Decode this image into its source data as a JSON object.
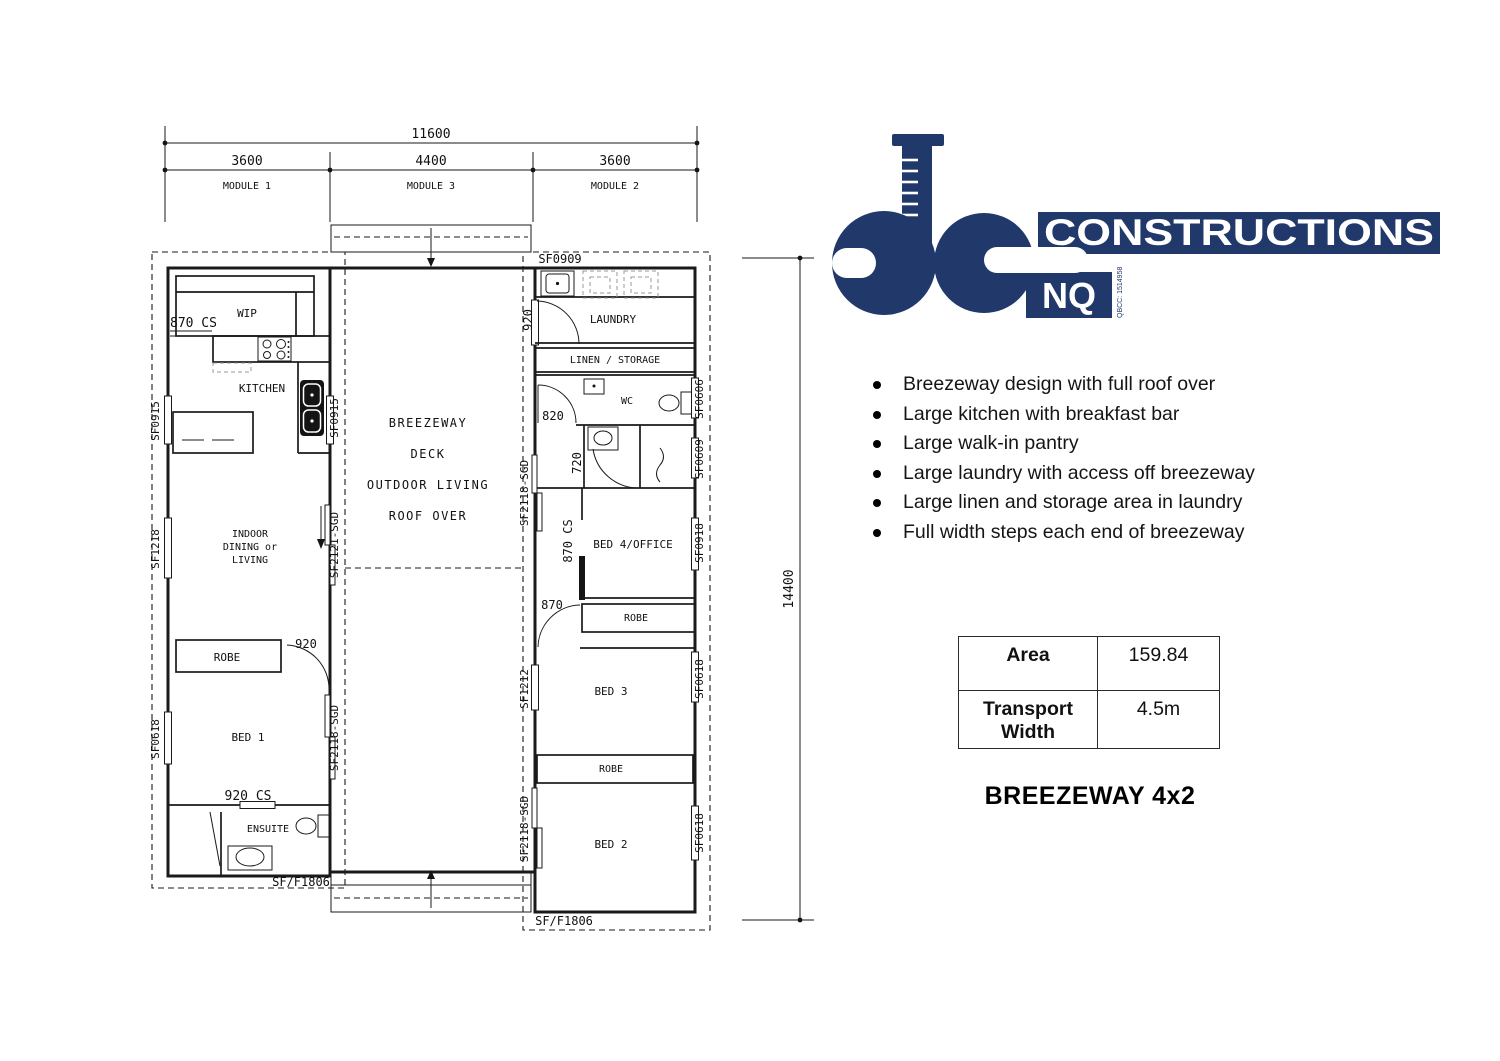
{
  "logo": {
    "constructions": "CONSTRUCTIONS",
    "nq": "NQ",
    "qbcc": "QBCC: 1514958",
    "navy": "#21386b"
  },
  "features": [
    "Breezeway design with full roof over",
    "Large kitchen with breakfast bar",
    "Large walk-in pantry",
    "Large laundry with access off breezeway",
    "Large linen and storage area in laundry",
    "Full width steps each end of breezeway"
  ],
  "spec_table": {
    "area_label": "Area",
    "area_value": "159.84",
    "tw_label": "Transport Width",
    "tw_value": "4.5m"
  },
  "plan_title": "BREEZEWAY 4x2",
  "plan": {
    "dim_total": "11600",
    "dim_module1": "3600",
    "dim_module3": "4400",
    "dim_module2": "3600",
    "dim_length": "14400",
    "module1_label": "MODULE 1",
    "module3_label": "MODULE 3",
    "module2_label": "MODULE 2",
    "rooms": {
      "wip": "WIP",
      "kitchen": "KITCHEN",
      "indoor1": "INDOOR",
      "indoor2": "DINING or",
      "indoor3": "LIVING",
      "robe1": "ROBE",
      "bed1": "BED 1",
      "ensuite": "ENSUITE",
      "bw1": "BREEZEWAY",
      "bw2": "DECK",
      "bw3": "OUTDOOR LIVING",
      "bw4": "ROOF OVER",
      "laundry": "LAUNDRY",
      "linen": "LINEN / STORAGE",
      "wc": "WC",
      "bed4": "BED 4/OFFICE",
      "robe2": "ROBE",
      "bed3": "BED 3",
      "robe3": "ROBE",
      "bed2": "BED 2"
    },
    "labels": {
      "cs870": "870 CS",
      "sf0915L": "SF0915",
      "sf0915R": "SF0915",
      "sf1218": "SF1218",
      "sf2121": "SF2121-SGD",
      "d920": "920",
      "sf0618L": "SF0618",
      "sf2118m1": "SF2118-SGD",
      "cs920": "920 CS",
      "sff1806L": "SF/F1806",
      "sf0909": "SF0909",
      "d920r": "920",
      "sf0606": "SF0606",
      "d820": "820",
      "d720": "720",
      "sf0609": "SF0609",
      "cs870r": "870 CS",
      "sf0918": "SF0918",
      "d870": "870",
      "sf2118r1": "SF2118-SGD",
      "sf1212": "SF1212",
      "sf0618r1": "SF0618",
      "sf2118r2": "SF2118-SGD",
      "sf0618r2": "SF0618",
      "sff1806R": "SF/F1806"
    }
  }
}
